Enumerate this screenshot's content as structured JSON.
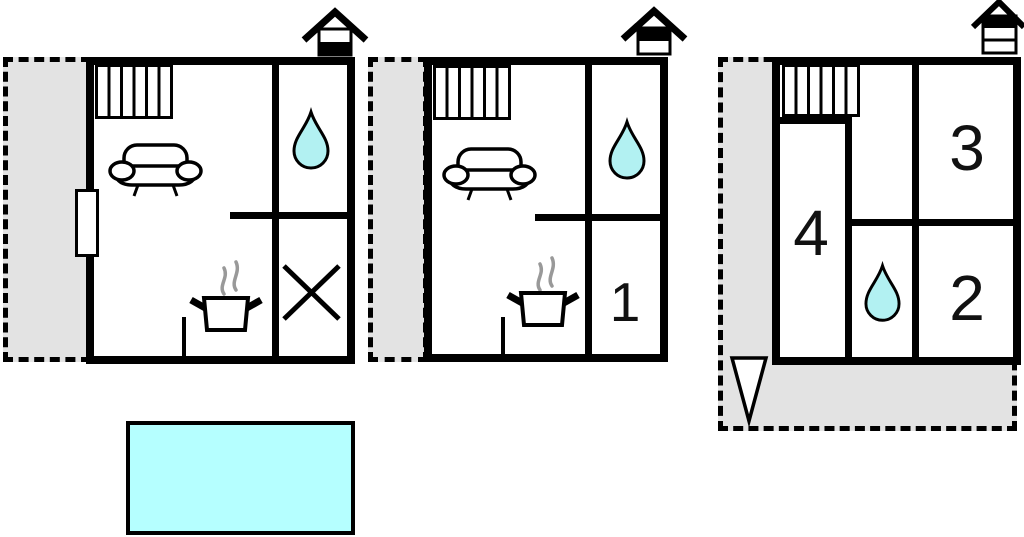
{
  "colors": {
    "background": "#ffffff",
    "wall": "#000000",
    "terrace_fill": "#e3e3e3",
    "water_fill": "#b2f1f2",
    "pool_fill": "#b5ffff",
    "steam": "#999999"
  },
  "room_labels": {
    "r1": "1",
    "r2": "2",
    "r3": "3",
    "r4": "4"
  },
  "icons": {
    "radiator": "radiator-icon",
    "sofa": "sofa-icon",
    "water_drop": "water-drop-icon",
    "stove": "stove-pot-icon",
    "steam": "steam-icon",
    "cross": "cross-marker-icon",
    "house_level_left": "house-level-ground-icon",
    "house_level_middle": "house-level-upper-icon",
    "house_level_right": "house-level-top-icon",
    "north_arrow": "north-arrow-icon",
    "pool": "swimming-pool"
  }
}
